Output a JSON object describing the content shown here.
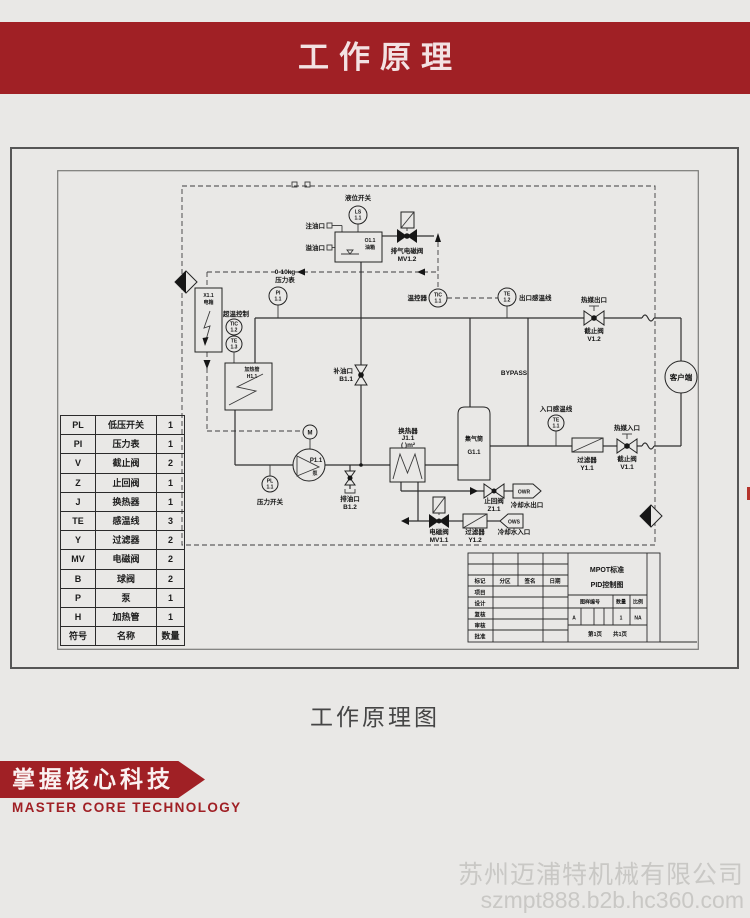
{
  "header": {
    "title": "工作原理"
  },
  "caption": "工作原理图",
  "footer": {
    "banner_cn": "掌握核心科技",
    "banner_en": "MASTER CORE TECHNOLOGY",
    "watermark_line1": "苏州迈浦特机械有限公司",
    "watermark_line2": "szmpt888.b2b.hc360.com"
  },
  "legend": {
    "rows": [
      {
        "s": "PL",
        "n": "低压开关",
        "q": "1"
      },
      {
        "s": "PI",
        "n": "压力表",
        "q": "1"
      },
      {
        "s": "V",
        "n": "截止阀",
        "q": "2"
      },
      {
        "s": "Z",
        "n": "止回阀",
        "q": "1"
      },
      {
        "s": "J",
        "n": "换热器",
        "q": "1"
      },
      {
        "s": "TE",
        "n": "感温线",
        "q": "3"
      },
      {
        "s": "Y",
        "n": "过滤器",
        "q": "2"
      },
      {
        "s": "MV",
        "n": "电磁阀",
        "q": "2"
      },
      {
        "s": "B",
        "n": "球阀",
        "q": "2"
      },
      {
        "s": "P",
        "n": "泵",
        "q": "1"
      },
      {
        "s": "H",
        "n": "加热管",
        "q": "1"
      },
      {
        "s": "符号",
        "n": "名称",
        "q": "数量"
      }
    ]
  },
  "diagram": {
    "level_switch": "液位开关",
    "ls_tag": "LS",
    "ls_no": "1.1",
    "fill_port": "注油口",
    "overflow_port": "溢油口",
    "tank_tag": "O1.1",
    "tank_name": "油箱",
    "exhaust_valve": "排气电磁阀",
    "exhaust_tag": "MV1.2",
    "gauge_range": "0-10kg",
    "gauge_name": "压力表",
    "pi_tag": "PI",
    "pi_no": "1.1",
    "ebox_tag": "X1.1",
    "ebox_name": "电箱",
    "overtemp": "超温控制",
    "tic2_tag": "TIC",
    "tic2_no": "1.2",
    "te3_tag": "TE",
    "te3_no": "1.3",
    "heater_name": "加热管",
    "heater_tag": "H1.1",
    "makeup_port": "补油口",
    "makeup_tag": "B1.1",
    "motor": "M",
    "pump_tag": "P1.1",
    "pump_name": "泵",
    "pl_tag": "PL",
    "pl_no": "1.1",
    "pressure_switch": "压力开关",
    "drain_port": "排油口",
    "drain_tag": "B1.2",
    "hx_name": "换热器",
    "hx_tag": "J1.1",
    "hx_area": "(  )m²",
    "temp_controller": "温控器",
    "tic1_tag": "TIC",
    "tic1_no": "1.1",
    "te2_tag": "TE",
    "te2_no": "1.2",
    "outlet_sensor": "出口感温线",
    "bypass": "BYPASS",
    "gas_name": "集气筒",
    "gas_tag": "G1.1",
    "hot_outlet": "热媒出口",
    "v2_name": "截止阀",
    "v2_tag": "V1.2",
    "client": "客户端",
    "inlet_sensor": "入口感温线",
    "te1_tag": "TE",
    "te1_no": "1.1",
    "filter1_name": "过滤器",
    "filter1_tag": "Y1.1",
    "hot_inlet": "热媒入口",
    "v1_name": "截止阀",
    "v1_tag": "V1.1",
    "check_name": "止回阀",
    "check_tag": "Z1.1",
    "owr": "OWR",
    "cw_outlet": "冷却水出口",
    "mv1_name": "电磁阀",
    "mv1_tag": "MV1.1",
    "filter2_name": "过滤器",
    "filter2_tag": "Y1.2",
    "ows": "OWS",
    "cw_inlet": "冷却水入口"
  },
  "title_block": {
    "title1": "MPOT标准",
    "title2": "PID控制图",
    "col1": "标记",
    "col2": "分区",
    "col3": "签名",
    "col4": "日期",
    "row1": "项目",
    "row2": "设计",
    "row3": "复核",
    "row4": "审核",
    "row5": "批准",
    "dwg_no": "图样编号",
    "qty": "数量",
    "scale": "比例",
    "size": "A",
    "qty_val": "1",
    "scale_val": "NA",
    "page1": "第1页",
    "page2": "共1页"
  }
}
